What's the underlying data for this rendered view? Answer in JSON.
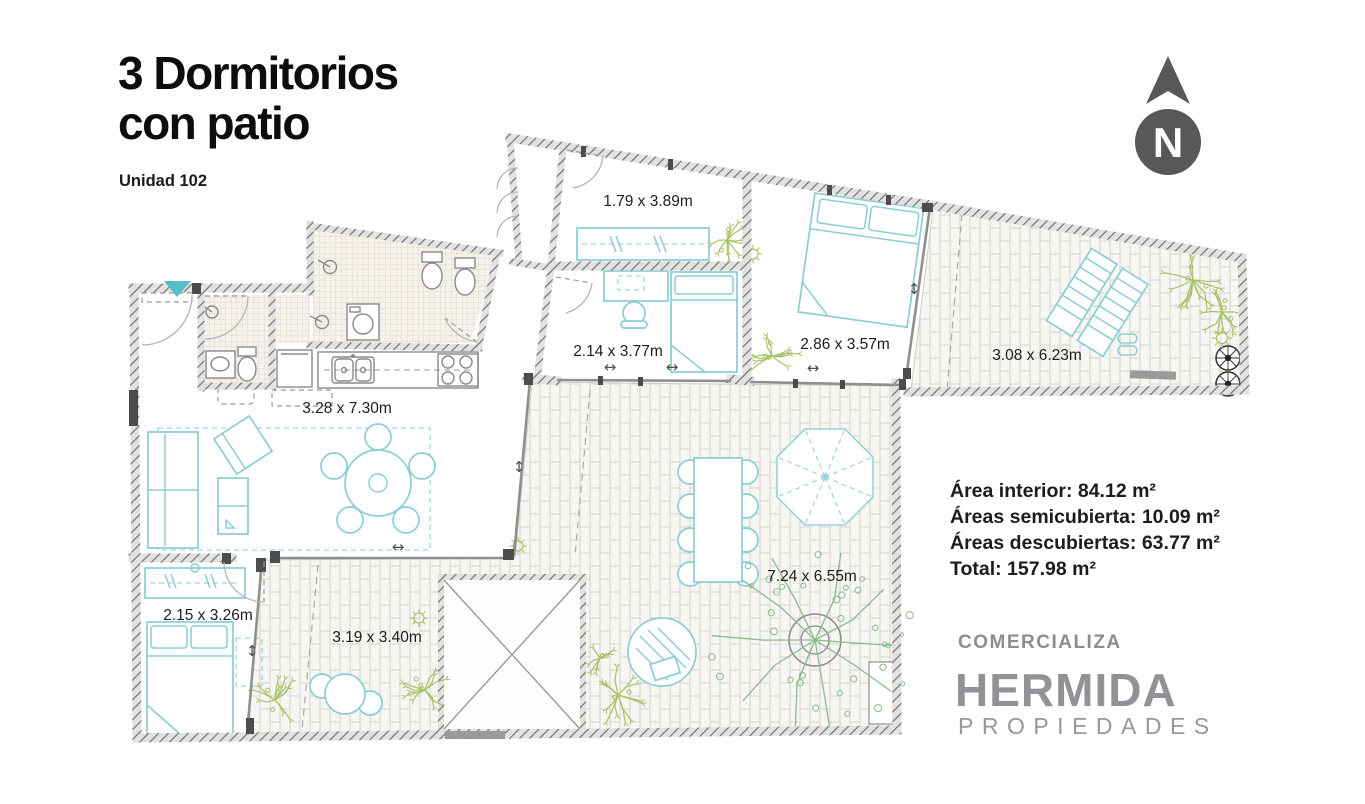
{
  "header": {
    "title_line1": "3 Dormitorios",
    "title_line2": "con patio",
    "unit_label": "Unidad 102"
  },
  "north_indicator": {
    "letter": "N"
  },
  "plan": {
    "rooms": [
      {
        "name": "dormitorio-1",
        "label": "1.79 x 3.89m"
      },
      {
        "name": "dormitorio-2",
        "label": "2.14 x 3.77m"
      },
      {
        "name": "dormitorio-principal",
        "label": "2.86 x 3.57m"
      },
      {
        "name": "terraza",
        "label": "3.08 x 6.23m"
      },
      {
        "name": "estar-cocina",
        "label": "3.28 x 7.30m"
      },
      {
        "name": "dormitorio-3",
        "label": "2.15 x 3.26m"
      },
      {
        "name": "patio-chico",
        "label": "3.19 x 3.40m"
      },
      {
        "name": "patio-grande",
        "label": "7.24 x 6.55m"
      }
    ]
  },
  "areas": {
    "interior": "Área interior: 84.12 m²",
    "semicubierta": "Áreas semicubierta: 10.09 m²",
    "descubiertas": "Áreas descubiertas: 63.77 m²",
    "total": "Total: 157.98 m²"
  },
  "branding": {
    "intro": "COMERCIALIZA",
    "name": "HERMIDA",
    "subtitle": "PROPIEDADES"
  },
  "colors": {
    "furniture": "#8ccdd5",
    "plant": "#a9c167",
    "tree": "#8cba8c",
    "accent_marker": "#54bec9",
    "north_gray": "#58585a",
    "brand_gray": "#919196"
  }
}
